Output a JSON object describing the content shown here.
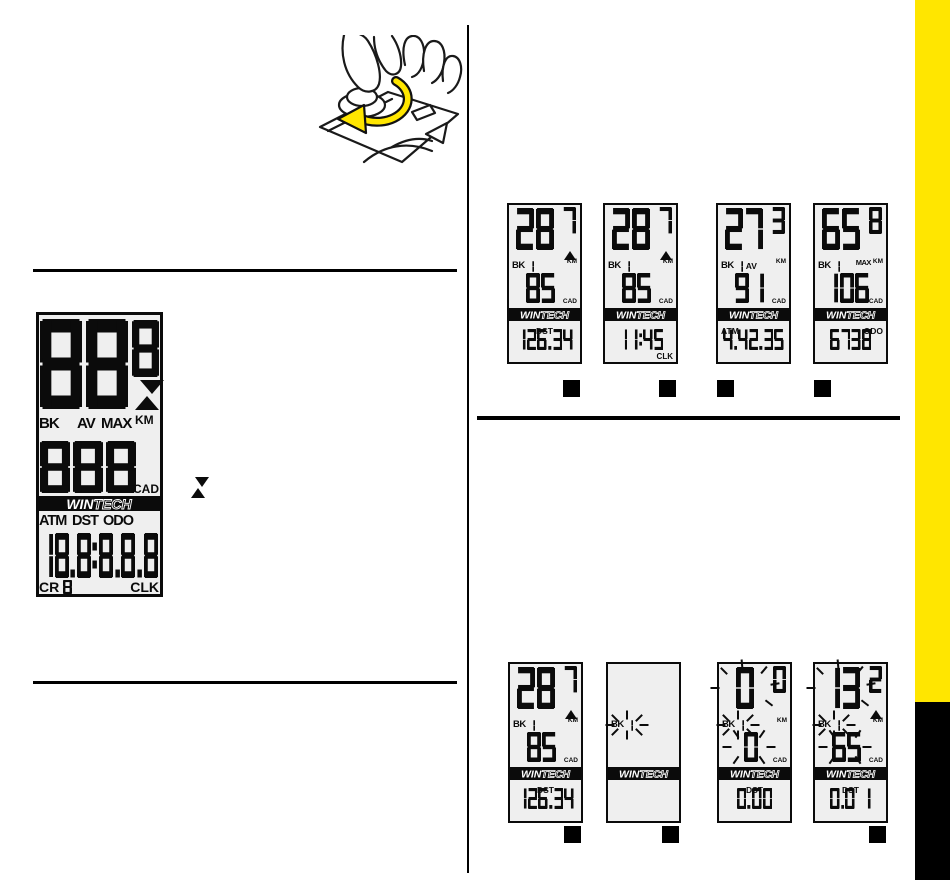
{
  "page": {
    "background": "#ffffff",
    "accent_yellow": "#ffe600",
    "ink": "#0b0b0b",
    "edge_tab": {
      "yellow": "#ffe600",
      "black": "#000000"
    }
  },
  "brand": {
    "win": "WIN",
    "tech": "TECH"
  },
  "illustration": {
    "name": "hands-rotating-battery-cap",
    "arrow_color": "#ffe600",
    "arrow_direction": "counter-clockwise"
  },
  "toggle_indicator": {
    "name": "up-down-toggle-icon"
  },
  "master_display": {
    "speed_main": "88",
    "speed_decimal": "8",
    "indicator": "up-down",
    "labels": {
      "bike_label": "BK",
      "bike_digit": "8",
      "avg": "AV",
      "max": "MAX",
      "unit": "KM"
    },
    "cadence": "888",
    "cadence_label": "CAD",
    "modes": {
      "atm": "ATM",
      "dst": "DST",
      "odo": "ODO"
    },
    "bottom_value": "18.8:8.8.8",
    "crank_label": "CR",
    "crank_digit": "8",
    "clock_label": "CLK"
  },
  "display_rows": {
    "top": [
      {
        "speed_main": "28",
        "speed_decimal": "7",
        "trend_up": true,
        "bike_label": "BK",
        "bike_digit": "1",
        "show_av": false,
        "show_max": false,
        "unit": "KM",
        "cadence": "85",
        "cadence_label": "CAD",
        "mode_label": "DST",
        "mode_align": "center",
        "bottom_value": "126.34",
        "corner_label": "",
        "blank": false,
        "blink_speed": false,
        "blink_bike": false,
        "blink_cadence": false,
        "button_below": "right"
      },
      {
        "speed_main": "28",
        "speed_decimal": "7",
        "trend_up": true,
        "bike_label": "BK",
        "bike_digit": "1",
        "show_av": false,
        "show_max": false,
        "unit": "KM",
        "cadence": "85",
        "cadence_label": "CAD",
        "mode_label": "",
        "mode_align": "center",
        "bottom_value": "11:45",
        "corner_label": "CLK",
        "blank": false,
        "blink_speed": false,
        "blink_bike": false,
        "blink_cadence": false,
        "button_below": "right"
      },
      {
        "speed_main": "27",
        "speed_decimal": "3",
        "trend_up": false,
        "bike_label": "BK",
        "bike_digit": "1",
        "show_av": true,
        "show_max": false,
        "unit": "KM",
        "cadence": "91",
        "cadence_label": "CAD",
        "mode_label": "ATM",
        "mode_align": "left",
        "bottom_value": "4.42.35",
        "corner_label": "",
        "blank": false,
        "blink_speed": false,
        "blink_bike": false,
        "blink_cadence": false,
        "button_below": "left"
      },
      {
        "speed_main": "65",
        "speed_decimal": "8",
        "trend_up": false,
        "bike_label": "BK",
        "bike_digit": "1",
        "show_av": false,
        "show_max": true,
        "unit": "KM",
        "cadence": "106",
        "cadence_label": "CAD",
        "mode_label": "ODO",
        "mode_align": "right",
        "bottom_value": "6738",
        "corner_label": "",
        "blank": false,
        "blink_speed": false,
        "blink_bike": false,
        "blink_cadence": false,
        "button_below": "left"
      }
    ],
    "bottom": [
      {
        "speed_main": "28",
        "speed_decimal": "7",
        "trend_up": true,
        "bike_label": "BK",
        "bike_digit": "1",
        "show_av": false,
        "show_max": false,
        "unit": "KM",
        "cadence": "85",
        "cadence_label": "CAD",
        "mode_label": "DST",
        "mode_align": "center",
        "bottom_value": "126.34",
        "corner_label": "",
        "blank": false,
        "blink_speed": false,
        "blink_bike": false,
        "blink_cadence": false,
        "button_below": "right"
      },
      {
        "speed_main": "",
        "speed_decimal": "",
        "trend_up": false,
        "bike_label": "BK",
        "bike_digit": "1",
        "show_av": false,
        "show_max": false,
        "unit": "",
        "cadence": "",
        "cadence_label": "",
        "mode_label": "",
        "mode_align": "center",
        "bottom_value": "",
        "corner_label": "",
        "blank": true,
        "blink_speed": false,
        "blink_bike": true,
        "blink_cadence": false,
        "button_below": "right"
      },
      {
        "speed_main": "0",
        "speed_decimal": "0",
        "trend_up": false,
        "bike_label": "BK",
        "bike_digit": "1",
        "show_av": false,
        "show_max": false,
        "unit": "KM",
        "cadence": "0",
        "cadence_label": "CAD",
        "mode_label": "DST",
        "mode_align": "center",
        "bottom_value": "0.00",
        "corner_label": "",
        "blank": false,
        "blink_speed": true,
        "blink_bike": true,
        "blink_cadence": true,
        "button_below": null
      },
      {
        "speed_main": "13",
        "speed_decimal": "2",
        "trend_up": true,
        "bike_label": "BK",
        "bike_digit": "1",
        "show_av": false,
        "show_max": false,
        "unit": "KM",
        "cadence": "65",
        "cadence_label": "CAD",
        "mode_label": "DST",
        "mode_align": "center",
        "bottom_value": "0.0 1",
        "corner_label": "",
        "blank": false,
        "blink_speed": true,
        "blink_bike": true,
        "blink_cadence": true,
        "button_below": "right"
      }
    ]
  }
}
